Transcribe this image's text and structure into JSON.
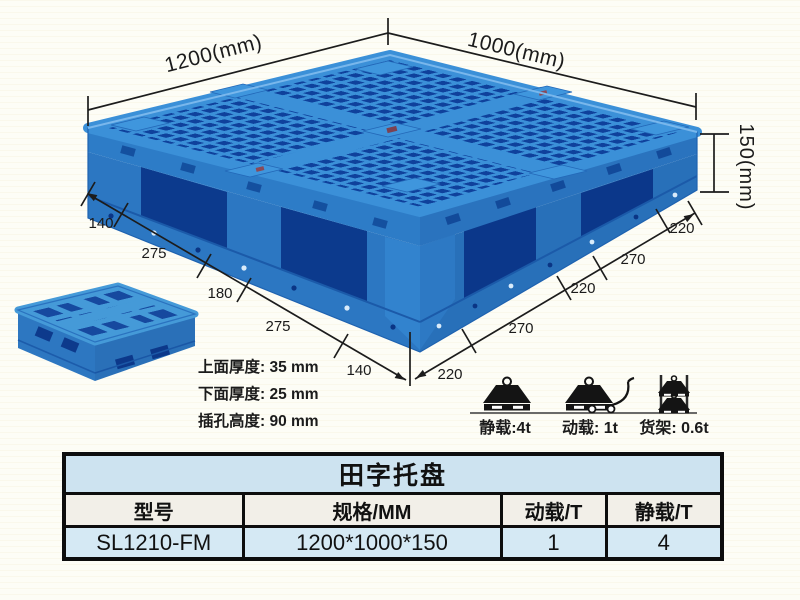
{
  "product_figure": {
    "dims": {
      "top_left_edge": "1200(mm)",
      "top_right_edge": "1000(mm)",
      "height": "150(mm)",
      "left_edge_segments": [
        "140",
        "275",
        "180",
        "275",
        "140"
      ],
      "right_edge_segments": [
        "220",
        "270",
        "220",
        "270",
        "220"
      ]
    },
    "notes": [
      "上面厚度: 35 mm",
      "下面厚度: 25 mm",
      "插孔高度: 90 mm"
    ],
    "load_ratings": [
      {
        "icon": "static-load-icon",
        "label": "静载:4t"
      },
      {
        "icon": "dynamic-load-icon",
        "label": "动载: 1t"
      },
      {
        "icon": "rack-load-icon",
        "label": "货架: 0.6t"
      }
    ]
  },
  "spec_table": {
    "title": "田字托盘",
    "columns": [
      "型号",
      "规格/MM",
      "动载/T",
      "静载/T"
    ],
    "rows": [
      [
        "SL1210-FM",
        "1200*1000*150",
        "1",
        "4"
      ]
    ]
  },
  "colors": {
    "pallet_rib_blue": "#3b90d8",
    "pallet_hole_blue": "#0f419c",
    "pallet_side_blue": "#2c77c2",
    "table_title_bg": "#cde3f0",
    "table_header_bg": "#f2efe8",
    "table_data_bg": "#d5e9f4",
    "line_color": "#1c1c1c"
  }
}
